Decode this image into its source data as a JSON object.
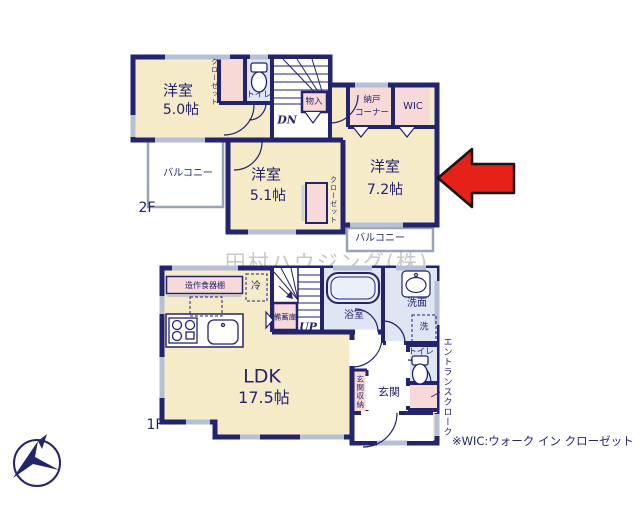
{
  "watermark": "田村ハウジング(株)",
  "note": "※WIC:ウォーク イン クローゼット",
  "floor2": {
    "label": "2F",
    "room_50": {
      "name": "洋室",
      "size": "5.0帖"
    },
    "room_51": {
      "name": "洋室",
      "size": "5.1帖"
    },
    "room_72": {
      "name": "洋室",
      "size": "7.2帖"
    },
    "closet_left": "クローゼット",
    "closet_mid": "クローゼット",
    "toilet": "トイレ",
    "storage": "物入",
    "nando_line1": "納戸",
    "nando_line2": "コーナー",
    "wic": "WIC",
    "stairs_down": "DN",
    "balcony_left": "バルコニー",
    "balcony_right": "バルコニー"
  },
  "floor1": {
    "label": "1F",
    "ldk": {
      "name": "LDK",
      "size": "17.5帖"
    },
    "cupboard": "造作食器棚",
    "fridge": "冷",
    "pantry": "備蓄庫",
    "stairs_up": "UP",
    "bath": "浴室",
    "washroom": "洗面",
    "laundry": "洗",
    "toilet": "トイレ",
    "entrance": "玄関",
    "entrance_storage": "玄関収納",
    "entrance_cloak": "エントランスクローク"
  },
  "colors": {
    "wall": "#23236e",
    "room_fill": "#f6ebc9",
    "closet_fill": "#f7d9d8",
    "wet_fill": "#dde6f2",
    "window": "#b7bfd4",
    "arrow_red": "#e62119",
    "watermark_gray": "#c9c9c9"
  }
}
